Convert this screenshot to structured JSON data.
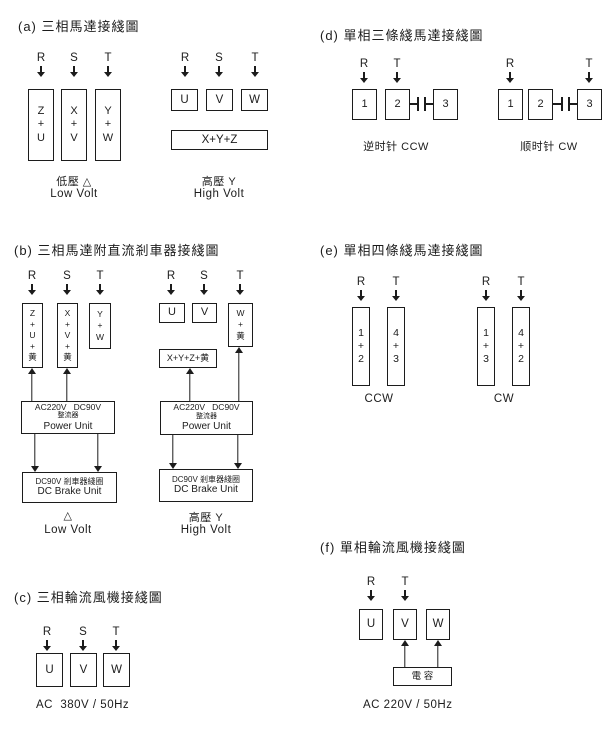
{
  "colors": {
    "ink": "#1c1c1c",
    "bg": "#ffffff"
  },
  "sections": [
    {
      "id": "a",
      "title": "(a) 三相馬達接綫圖",
      "title_pos": {
        "x": 18,
        "y": 16
      },
      "terminals": [
        {
          "label": "R",
          "x": 41,
          "y": 52
        },
        {
          "label": "S",
          "x": 74,
          "y": 52
        },
        {
          "label": "T",
          "x": 108,
          "y": 52
        },
        {
          "label": "R",
          "x": 185,
          "y": 52
        },
        {
          "label": "S",
          "x": 219,
          "y": 52
        },
        {
          "label": "T",
          "x": 255,
          "y": 52
        }
      ],
      "boxes": [
        {
          "name": "winding-box-zu",
          "x": 28,
          "y": 89,
          "w": 26,
          "h": 72,
          "lines": [
            "Z",
            "+",
            "U"
          ],
          "fs": 11
        },
        {
          "name": "winding-box-xv",
          "x": 61,
          "y": 89,
          "w": 26,
          "h": 72,
          "lines": [
            "X",
            "+",
            "V"
          ],
          "fs": 11
        },
        {
          "name": "winding-box-yw",
          "x": 95,
          "y": 89,
          "w": 26,
          "h": 72,
          "lines": [
            "Y",
            "+",
            "W"
          ],
          "fs": 11
        },
        {
          "name": "terminal-box-u",
          "x": 171,
          "y": 89,
          "w": 27,
          "h": 22,
          "lines": [
            "U"
          ],
          "fs": 11.5
        },
        {
          "name": "terminal-box-v",
          "x": 206,
          "y": 89,
          "w": 27,
          "h": 22,
          "lines": [
            "V"
          ],
          "fs": 11.5
        },
        {
          "name": "terminal-box-w",
          "x": 241,
          "y": 89,
          "w": 27,
          "h": 22,
          "lines": [
            "W"
          ],
          "fs": 11.5
        },
        {
          "name": "winding-box-xyz",
          "x": 171,
          "y": 130,
          "w": 97,
          "h": 20,
          "lines": [
            "X+Y+Z"
          ],
          "fs": 11.5
        }
      ],
      "arrows": [],
      "capacitors": [],
      "captions": [
        {
          "name": "caption-low-volt-cn",
          "text": "低壓 △",
          "cx": 74,
          "y": 173,
          "fs": 11
        },
        {
          "name": "caption-low-volt-en",
          "text": "Low Volt",
          "cx": 74,
          "y": 188,
          "fs": 11.5
        },
        {
          "name": "caption-high-volt-cn",
          "text": "高壓 Y",
          "cx": 219,
          "y": 173,
          "fs": 11
        },
        {
          "name": "caption-high-volt-en",
          "text": "High Volt",
          "cx": 219,
          "y": 188,
          "fs": 11.5
        }
      ]
    },
    {
      "id": "b",
      "title": "(b) 三相馬達附直流剎車器接綫圖",
      "title_pos": {
        "x": 14,
        "y": 240
      },
      "terminals": [
        {
          "label": "R",
          "x": 32,
          "y": 270
        },
        {
          "label": "S",
          "x": 67,
          "y": 270
        },
        {
          "label": "T",
          "x": 100,
          "y": 270
        },
        {
          "label": "R",
          "x": 171,
          "y": 270
        },
        {
          "label": "S",
          "x": 204,
          "y": 270
        },
        {
          "label": "T",
          "x": 240,
          "y": 270
        }
      ],
      "boxes": [
        {
          "name": "winding-box-zu-yellow",
          "x": 22,
          "y": 303,
          "w": 21,
          "h": 65,
          "lines": [
            "Z",
            "+",
            "U",
            "+",
            "黄"
          ],
          "fs": 8.5,
          "lh": 1.3
        },
        {
          "name": "winding-box-xv-yellow",
          "x": 57,
          "y": 303,
          "w": 21,
          "h": 65,
          "lines": [
            "X",
            "+",
            "V",
            "+",
            "黄"
          ],
          "fs": 8.5,
          "lh": 1.3
        },
        {
          "name": "winding-box-yw",
          "x": 89,
          "y": 303,
          "w": 22,
          "h": 46,
          "lines": [
            "Y",
            "+",
            "W"
          ],
          "fs": 8.5,
          "lh": 1.3
        },
        {
          "name": "power-unit-box",
          "x": 21,
          "y": 401,
          "w": 94,
          "h": 33,
          "lines": [
            "AC220V   DC90V",
            "整流器",
            "Power Unit"
          ],
          "lineFs": [
            8.5,
            7,
            10
          ]
        },
        {
          "name": "brake-unit-box",
          "x": 22,
          "y": 472,
          "w": 95,
          "h": 31,
          "lines": [
            "DC90V 剎車器綫圈",
            "DC Brake Unit"
          ],
          "lineFs": [
            8,
            10
          ]
        },
        {
          "name": "terminal-box-u",
          "x": 159,
          "y": 303,
          "w": 26,
          "h": 20,
          "lines": [
            "U"
          ],
          "fs": 11
        },
        {
          "name": "terminal-box-v",
          "x": 192,
          "y": 303,
          "w": 25,
          "h": 20,
          "lines": [
            "V"
          ],
          "fs": 11
        },
        {
          "name": "winding-box-w-yellow",
          "x": 228,
          "y": 303,
          "w": 25,
          "h": 44,
          "lines": [
            "W",
            "+",
            "黄"
          ],
          "fs": 8.5,
          "lh": 1.3
        },
        {
          "name": "winding-box-xyz-yellow",
          "x": 159,
          "y": 349,
          "w": 58,
          "h": 19,
          "lines": [
            "X+Y+Z+黄"
          ],
          "fs": 9
        },
        {
          "name": "power-unit-box",
          "x": 160,
          "y": 401,
          "w": 93,
          "h": 34,
          "lines": [
            "AC220V   DC90V",
            "整流器",
            "Power Unit"
          ],
          "lineFs": [
            8.5,
            7,
            10
          ]
        },
        {
          "name": "brake-unit-box",
          "x": 159,
          "y": 469,
          "w": 94,
          "h": 33,
          "lines": [
            "DC90V 剎車器綫圈",
            "DC Brake Unit"
          ],
          "lineFs": [
            8,
            10
          ]
        }
      ],
      "arrows": [
        {
          "x": 32,
          "y1": 368,
          "y2": 401,
          "dir": "up"
        },
        {
          "x": 67,
          "y1": 368,
          "y2": 401,
          "dir": "up"
        },
        {
          "x": 35,
          "y1": 434,
          "y2": 472,
          "dir": "down"
        },
        {
          "x": 98,
          "y1": 434,
          "y2": 472,
          "dir": "down"
        },
        {
          "x": 190,
          "y1": 368,
          "y2": 401,
          "dir": "up"
        },
        {
          "x": 239,
          "y1": 347,
          "y2": 401,
          "dir": "up"
        },
        {
          "x": 173,
          "y1": 435,
          "y2": 469,
          "dir": "down"
        },
        {
          "x": 238,
          "y1": 435,
          "y2": 469,
          "dir": "down"
        }
      ],
      "capacitors": [],
      "captions": [
        {
          "name": "caption-delta",
          "text": "△",
          "cx": 68,
          "y": 509,
          "fs": 11
        },
        {
          "name": "caption-low-volt-en",
          "text": "Low Volt",
          "cx": 68,
          "y": 524,
          "fs": 11.5
        },
        {
          "name": "caption-high-volt-cn",
          "text": "高壓 Y",
          "cx": 206,
          "y": 509,
          "fs": 11
        },
        {
          "name": "caption-high-volt-en",
          "text": "High Volt",
          "cx": 206,
          "y": 524,
          "fs": 11.5
        }
      ]
    },
    {
      "id": "c",
      "title": "(c) 三相輪流風機接綫圖",
      "title_pos": {
        "x": 14,
        "y": 587
      },
      "terminals": [
        {
          "label": "R",
          "x": 47,
          "y": 626
        },
        {
          "label": "S",
          "x": 83,
          "y": 626
        },
        {
          "label": "T",
          "x": 116,
          "y": 626
        }
      ],
      "boxes": [
        {
          "name": "terminal-box-u",
          "x": 36,
          "y": 653,
          "w": 27,
          "h": 34,
          "lines": [
            "U"
          ],
          "fs": 11.5
        },
        {
          "name": "terminal-box-v",
          "x": 70,
          "y": 653,
          "w": 27,
          "h": 34,
          "lines": [
            "V"
          ],
          "fs": 11.5
        },
        {
          "name": "terminal-box-w",
          "x": 103,
          "y": 653,
          "w": 27,
          "h": 34,
          "lines": [
            "W"
          ],
          "fs": 11.5
        }
      ],
      "arrows": [],
      "capacitors": [],
      "captions": [
        {
          "name": "caption-power-spec",
          "text": "AC  380V / 50Hz",
          "x": 36,
          "y": 699,
          "align": "left",
          "fs": 11.5
        }
      ]
    },
    {
      "id": "d",
      "title": "(d) 單相三條綫馬達接綫圖",
      "title_pos": {
        "x": 320,
        "y": 25
      },
      "terminals": [
        {
          "label": "R",
          "x": 364,
          "y": 58
        },
        {
          "label": "T",
          "x": 397,
          "y": 58
        },
        {
          "label": "R",
          "x": 510,
          "y": 58
        },
        {
          "label": "T",
          "x": 589,
          "y": 58
        }
      ],
      "boxes": [
        {
          "name": "terminal-box-1",
          "x": 352,
          "y": 89,
          "w": 25,
          "h": 31,
          "lines": [
            "1"
          ],
          "fs": 11
        },
        {
          "name": "terminal-box-2",
          "x": 385,
          "y": 89,
          "w": 25,
          "h": 31,
          "lines": [
            "2"
          ],
          "fs": 11
        },
        {
          "name": "terminal-box-3",
          "x": 433,
          "y": 89,
          "w": 25,
          "h": 31,
          "lines": [
            "3"
          ],
          "fs": 11
        },
        {
          "name": "terminal-box-1",
          "x": 498,
          "y": 89,
          "w": 25,
          "h": 31,
          "lines": [
            "1"
          ],
          "fs": 11
        },
        {
          "name": "terminal-box-2",
          "x": 528,
          "y": 89,
          "w": 25,
          "h": 31,
          "lines": [
            "2"
          ],
          "fs": 11
        },
        {
          "name": "terminal-box-3",
          "x": 577,
          "y": 89,
          "w": 25,
          "h": 31,
          "lines": [
            "3"
          ],
          "fs": 11
        }
      ],
      "arrows": [],
      "capacitors": [
        {
          "x1": 410,
          "x2": 433,
          "y": 104
        },
        {
          "x1": 553,
          "x2": 577,
          "y": 104
        }
      ],
      "captions": [
        {
          "name": "caption-ccw",
          "text": "逆时针 CCW",
          "cx": 396,
          "y": 138,
          "fs": 11
        },
        {
          "name": "caption-cw",
          "text": "顺时针 CW",
          "cx": 549,
          "y": 138,
          "fs": 11
        }
      ]
    },
    {
      "id": "e",
      "title": "(e) 單相四條綫馬達接綫圖",
      "title_pos": {
        "x": 320,
        "y": 240
      },
      "terminals": [
        {
          "label": "R",
          "x": 361,
          "y": 276
        },
        {
          "label": "T",
          "x": 396,
          "y": 276
        },
        {
          "label": "R",
          "x": 486,
          "y": 276
        },
        {
          "label": "T",
          "x": 521,
          "y": 276
        }
      ],
      "boxes": [
        {
          "name": "winding-box-12",
          "x": 352,
          "y": 307,
          "w": 18,
          "h": 79,
          "lines": [
            "1",
            "+",
            "2"
          ],
          "fs": 10.5
        },
        {
          "name": "winding-box-43",
          "x": 387,
          "y": 307,
          "w": 18,
          "h": 79,
          "lines": [
            "4",
            "+",
            "3"
          ],
          "fs": 10.5
        },
        {
          "name": "winding-box-13",
          "x": 477,
          "y": 307,
          "w": 18,
          "h": 79,
          "lines": [
            "1",
            "+",
            "3"
          ],
          "fs": 10.5
        },
        {
          "name": "winding-box-42",
          "x": 512,
          "y": 307,
          "w": 18,
          "h": 79,
          "lines": [
            "4",
            "+",
            "2"
          ],
          "fs": 10.5
        }
      ],
      "arrows": [],
      "capacitors": [],
      "captions": [
        {
          "name": "caption-ccw",
          "text": "CCW",
          "cx": 379,
          "y": 393,
          "fs": 11.5
        },
        {
          "name": "caption-cw",
          "text": "CW",
          "cx": 504,
          "y": 393,
          "fs": 11.5
        }
      ]
    },
    {
      "id": "f",
      "title": "(f) 單相輪流風機接綫圖",
      "title_pos": {
        "x": 320,
        "y": 537
      },
      "terminals": [
        {
          "label": "R",
          "x": 371,
          "y": 576
        },
        {
          "label": "T",
          "x": 405,
          "y": 576
        }
      ],
      "boxes": [
        {
          "name": "terminal-box-u",
          "x": 359,
          "y": 609,
          "w": 24,
          "h": 31,
          "lines": [
            "U"
          ],
          "fs": 11.5
        },
        {
          "name": "terminal-box-v",
          "x": 393,
          "y": 609,
          "w": 24,
          "h": 31,
          "lines": [
            "V"
          ],
          "fs": 11.5
        },
        {
          "name": "terminal-box-w",
          "x": 426,
          "y": 609,
          "w": 24,
          "h": 31,
          "lines": [
            "W"
          ],
          "fs": 11.5
        },
        {
          "name": "capacitor-box",
          "x": 393,
          "y": 667,
          "w": 59,
          "h": 19,
          "lines": [
            "電 容"
          ],
          "fs": 9.5
        }
      ],
      "arrows": [
        {
          "x": 405,
          "y1": 640,
          "y2": 667,
          "dir": "up"
        },
        {
          "x": 438,
          "y1": 640,
          "y2": 667,
          "dir": "up"
        }
      ],
      "capacitors": [],
      "captions": [
        {
          "name": "caption-power-spec",
          "text": "AC 220V / 50Hz",
          "x": 363,
          "y": 699,
          "align": "left",
          "fs": 11.5
        }
      ]
    }
  ]
}
